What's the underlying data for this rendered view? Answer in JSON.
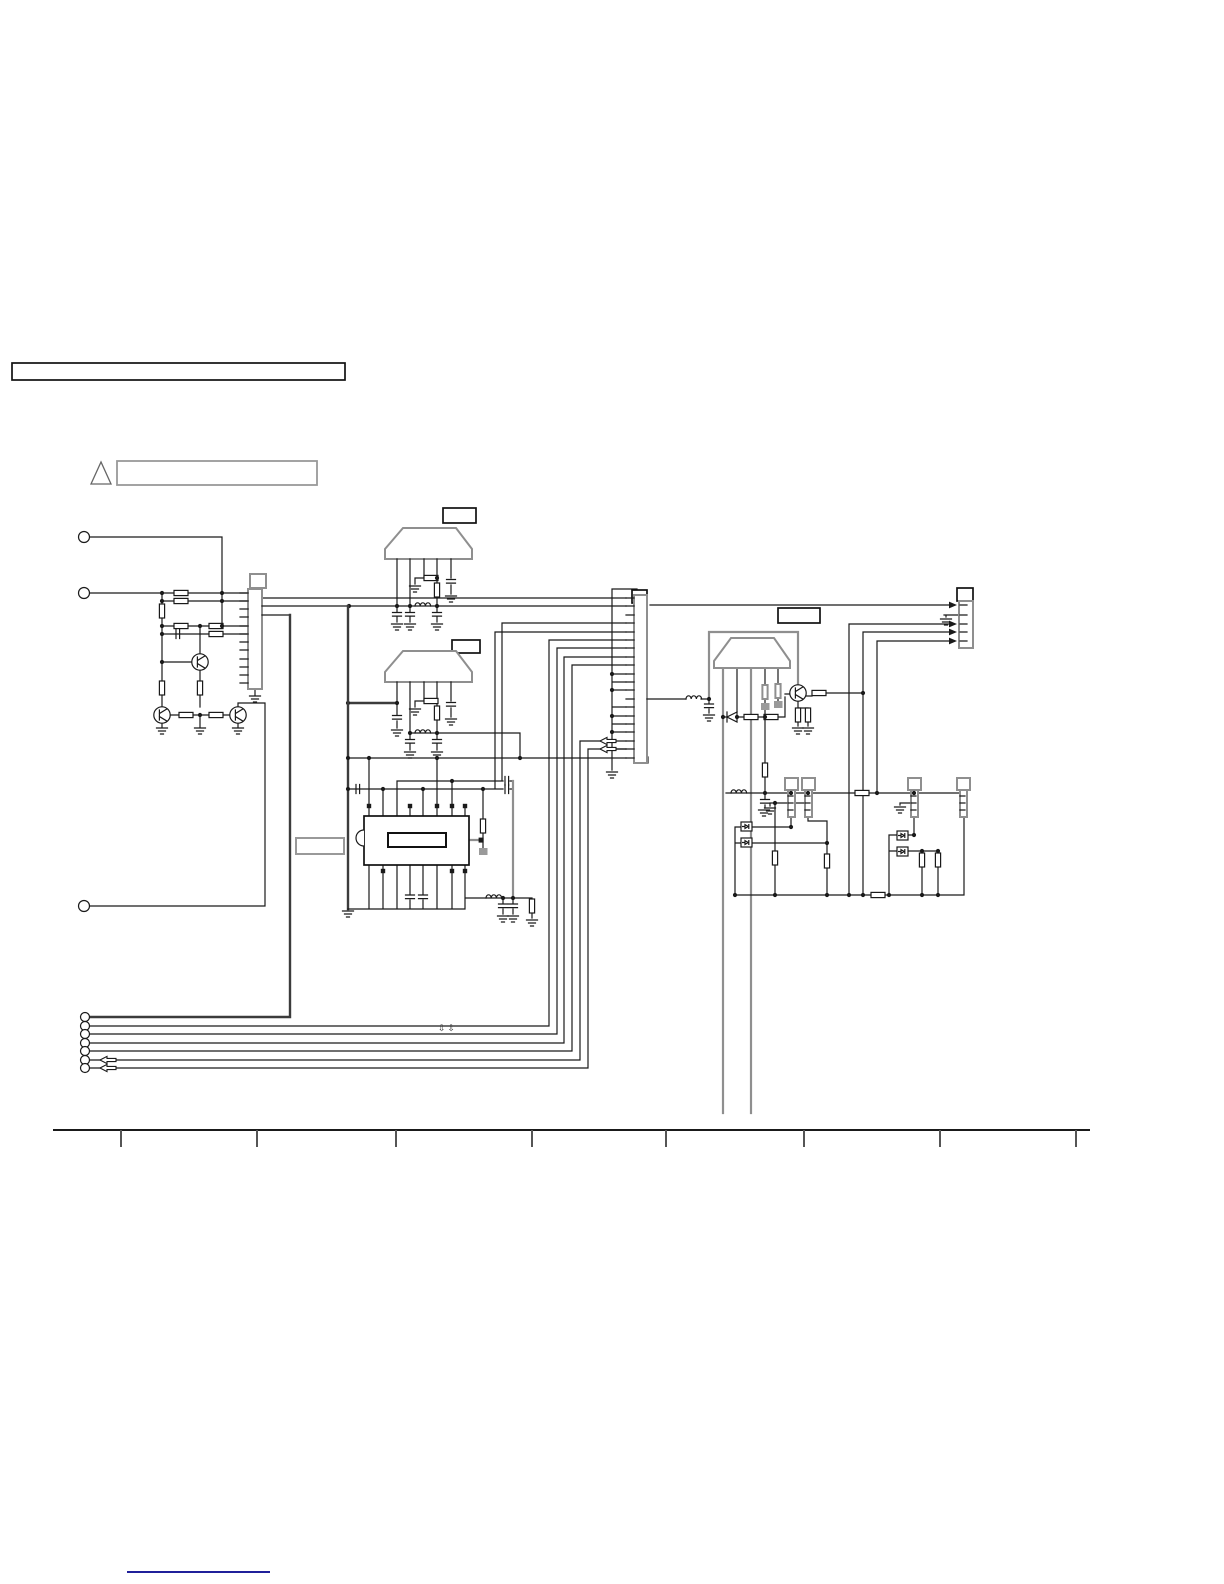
{
  "page": {
    "background": "#ffffff",
    "width": 1224,
    "height": 1584
  },
  "colors": {
    "wire": "#1a1a1a",
    "thick_wire": "#3c3c3c",
    "component_outline": "#8f8f8f",
    "label_box_outline": "#111111",
    "link_underline": "#00008b",
    "ruler_tick": "#555555"
  },
  "title_box": {
    "text": ""
  },
  "warning_note": {
    "text": "",
    "icon": "warning-triangle"
  },
  "labels": {
    "filter1": "",
    "filter2": "",
    "filter3": "",
    "ic": "",
    "ic_inner": ""
  },
  "wire_marks": {
    "text": "⇩⇩"
  },
  "footer": {
    "link_text": ""
  },
  "schematic_summary": {
    "left_input_terminals": 3,
    "bottom_terminals": 7,
    "left_connector_pins": 12,
    "center_connector_pins": 20,
    "right_connector_pins": 5,
    "jacks": 4,
    "filter_components": 3,
    "transistors": 4,
    "ics": 1
  },
  "ruler": {
    "tick_count": 8
  }
}
